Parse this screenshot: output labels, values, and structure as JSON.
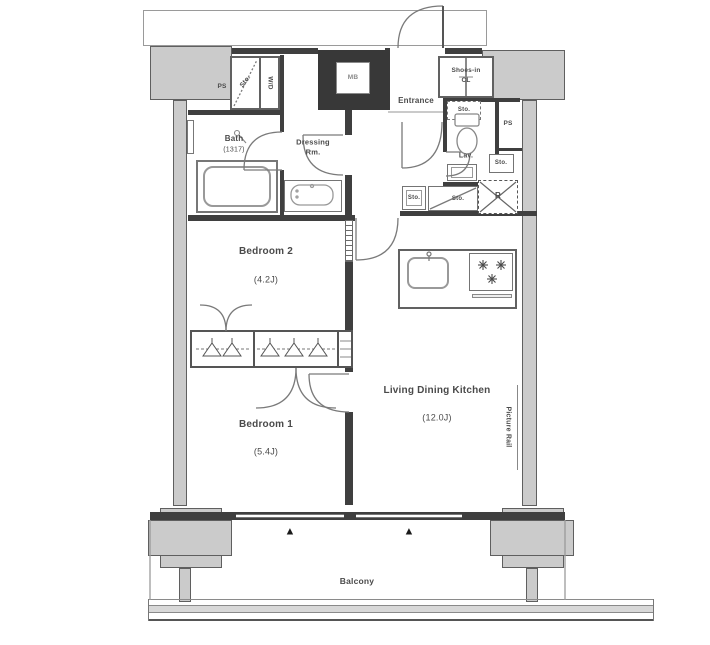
{
  "rooms": {
    "bath": {
      "name": "Bath",
      "size": "(1317)"
    },
    "dressing_room": {
      "name": "Dressing",
      "name2": "Rm."
    },
    "entrance": {
      "name": "Entrance"
    },
    "shoes_closet": {
      "name": "Shoes-in",
      "name2": "CL"
    },
    "lavatory": {
      "name": "Lav."
    },
    "bedroom2": {
      "name": "Bedroom 2",
      "size": "(4.2J)"
    },
    "bedroom1": {
      "name": "Bedroom 1",
      "size": "(5.4J)"
    },
    "living_dining_kitchen": {
      "name": "Living Dining Kitchen",
      "size": "(12.0J)"
    },
    "balcony": {
      "name": "Balcony"
    }
  },
  "labels": {
    "meter_box": "MB",
    "pipe_space_left": "PS",
    "pipe_space_right": "PS",
    "washer_dryer": "W/D",
    "storage_top_left": "Sto.",
    "storage_entrance": "Sto.",
    "storage_lavatory": "Sto.",
    "storage_hall_1": "Sto.",
    "storage_hall_2": "Sto.",
    "refrigerator": "R",
    "picture_rail": "Picture Rail",
    "window_marker": "▲"
  },
  "colors": {
    "wall": "#3f3f3f",
    "structure_fill": "#cbcbcb",
    "fixture_line": "#7a7a7a",
    "text": "#4a4a4a"
  }
}
